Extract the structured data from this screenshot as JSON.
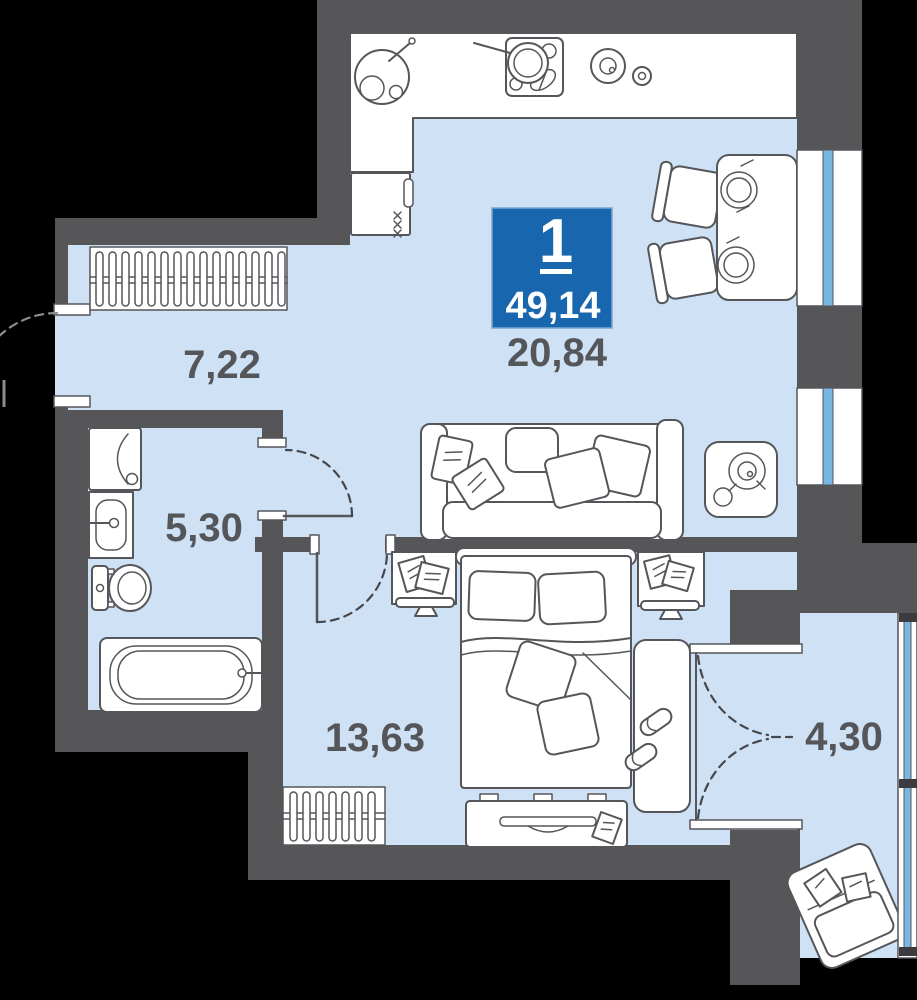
{
  "badge": {
    "rooms_count": "1",
    "total_area": "49,14"
  },
  "rooms": {
    "hallway": {
      "area": "7,22"
    },
    "kitchen_living": {
      "area": "20,84"
    },
    "bathroom": {
      "area": "5,30"
    },
    "bedroom": {
      "area": "13,63"
    },
    "balcony": {
      "area": "4,30"
    }
  },
  "colors": {
    "background": "#000000",
    "floor": "#cfe1f4",
    "walls": "#565659",
    "badge_bg": "#1766ae",
    "badge_text": "#ffffff",
    "window_glass": "#79b6e3",
    "label_text": "#55565a"
  },
  "icons": [
    "kitchen-sink-icon",
    "stove-icon",
    "frying-pan-icon",
    "pot-icon",
    "fridge-icon",
    "dining-table-icon",
    "chair-icon",
    "sofa-icon",
    "side-table-icon",
    "wardrobe-icon",
    "washing-machine-icon",
    "washbasin-icon",
    "toilet-icon",
    "bathtub-icon",
    "bed-icon",
    "nightstand-icon",
    "monitor-icon",
    "tv-stand-icon",
    "radiator-icon",
    "rug-icon",
    "slippers-icon",
    "lounge-chair-icon",
    "window-icon",
    "door-swing-icon"
  ]
}
